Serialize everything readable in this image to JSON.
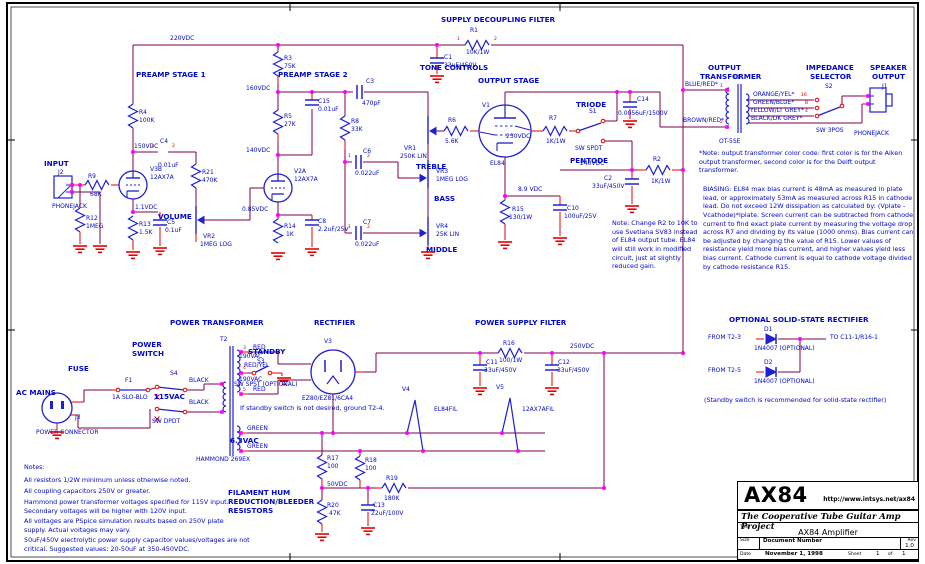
{
  "titleblock": {
    "logo": "AX84",
    "url": "http://www.intsys.net/ax84",
    "project": "The Cooperative Tube Guitar Amp Project",
    "title_label": "Title",
    "title": "AX84 Amplifier",
    "size_label": "Size",
    "doc_label": "Document Number",
    "rev_label": "Rev",
    "rev": "1.0",
    "date_label": "Date",
    "date": "November 1, 1998",
    "sheet_label": "Sheet",
    "sheet": "1",
    "of_label": "of",
    "sheet_total": "1"
  },
  "notes": {
    "heading": "Notes:",
    "n1": "All resistors 1/2W minimum unless otherwise noted.",
    "n2": "All coupling capacitors 250V or greater.",
    "n3": "Hammond power transformer voltages specified for 115V input.  Secondary voltages will be higher with 120V input.",
    "n4": "All voltages are PSpice simulation results based on 250V plate supply. Actual voltages may vary.",
    "n5": "50uF/450V electrolytic power supply capacitor values/voltages are not critical.  Suggested values: 20-50uF at 350-450VDC.",
    "ot_note": "*Note: output transformer color code: first color is for the Aiken output transformer, second color is for the Delft output transformer.",
    "biasing": "BIASING:  EL84 max bias current is 48mA as measured in plate lead,  or approximately 53mA as measured across R15 in cathode lead.  Do not exceed 12W dissipation as calculated by: (Vplate - Vcathode)*Iplate.  Screen current can be subtracted from cathode current to find exact plate current by measuring the voltage drop across R7 and dividing by its value (1000 ohms).  Bias current can be adjusted by changing the value of R15.  Lower values of resistance yield more bias current, and higher values yield less bias current.  Cathode current is equal to cathode voltage divided by cathode resistance R15.",
    "sv83_note": "Note: Change R2 to 10K to use Svetlana SV83 instead of EL84 output tube. EL84 will still work in modified circuit, just at slightly reduced gain.",
    "standby_note": "If standby switch is not desired, ground T2-4.",
    "ss_note": "(Standby switch is recommended for solid-state rectifier)"
  },
  "colors": {
    "wire": "#7d004f",
    "lead": "#e60000",
    "component": "#2020d0",
    "junction": "#ff00ff",
    "label": "#0008cc"
  },
  "labels": [
    [
      "SUPPLY DECOUPLING FILTER",
      441,
      16,
      "b"
    ],
    [
      "PREAMP STAGE 1",
      136,
      71,
      "b"
    ],
    [
      "PREAMP STAGE 2",
      278,
      71,
      "b"
    ],
    [
      "TONE CONTROLS",
      420,
      64,
      "b"
    ],
    [
      "OUTPUT STAGE",
      478,
      77,
      "b"
    ],
    [
      "TRIODE",
      576,
      101,
      "b"
    ],
    [
      "PENTODE",
      570,
      157,
      "b"
    ],
    [
      "INPUT",
      44,
      160,
      "b"
    ],
    [
      "VOLUME",
      158,
      213,
      "b"
    ],
    [
      "TREBLE",
      416,
      163,
      "b"
    ],
    [
      "BASS",
      434,
      195,
      "b"
    ],
    [
      "MIDDLE",
      426,
      246,
      "b"
    ],
    [
      "OUTPUT",
      708,
      64,
      "b"
    ],
    [
      "TRANSFORMER",
      700,
      73,
      "b"
    ],
    [
      "IMPEDANCE",
      806,
      64,
      "b"
    ],
    [
      "SELECTOR",
      810,
      73,
      "b"
    ],
    [
      "SPEAKER",
      870,
      64,
      "b"
    ],
    [
      "OUTPUT",
      872,
      73,
      "b"
    ],
    [
      "POWER TRANSFORMER",
      170,
      319,
      "b"
    ],
    [
      "RECTIFIER",
      314,
      319,
      "b"
    ],
    [
      "POWER SUPPLY FILTER",
      475,
      319,
      "b"
    ],
    [
      "OPTIONAL SOLID-STATE RECTIFIER",
      729,
      316,
      "b"
    ],
    [
      "POWER",
      132,
      341,
      "b"
    ],
    [
      "SWITCH",
      132,
      350,
      "b"
    ],
    [
      "FUSE",
      68,
      365,
      "b"
    ],
    [
      "AC MAINS",
      16,
      389,
      "b"
    ],
    [
      "STANDBY",
      248,
      348,
      "b"
    ],
    [
      "115VAC",
      154,
      393,
      "b"
    ],
    [
      "6.3VAC",
      230,
      437,
      "b"
    ],
    [
      "FILAMENT HUM",
      228,
      489,
      "b"
    ],
    [
      "REDUCTION/BLEEDER",
      228,
      498,
      "b"
    ],
    [
      "RESISTORS",
      228,
      507,
      "b"
    ],
    [
      "220VDC",
      170,
      36,
      "n"
    ],
    [
      "R1",
      470,
      28,
      "n"
    ],
    [
      "10K/1W",
      466,
      50,
      "n"
    ],
    [
      "C1",
      444,
      55,
      "n"
    ],
    [
      "33uF/450V",
      444,
      63,
      "n"
    ],
    [
      "R4",
      139,
      110,
      "n"
    ],
    [
      "100K",
      139,
      118,
      "n"
    ],
    [
      "150VDC",
      134,
      144,
      "n"
    ],
    [
      "C4",
      160,
      139,
      "n"
    ],
    [
      "0.01uF",
      158,
      163,
      "n"
    ],
    [
      "V3B",
      150,
      167,
      "n"
    ],
    [
      "12AX7A",
      150,
      175,
      "n"
    ],
    [
      "J2",
      58,
      170,
      "n"
    ],
    [
      "PHONEJACK",
      52,
      204,
      "n"
    ],
    [
      "R9",
      88,
      174,
      "n"
    ],
    [
      "68K",
      90,
      192,
      "n"
    ],
    [
      "R12",
      86,
      216,
      "n"
    ],
    [
      "1MEG",
      86,
      224,
      "n"
    ],
    [
      "1.1VDC",
      135,
      205,
      "n"
    ],
    [
      "R13",
      139,
      222,
      "n"
    ],
    [
      "1.5K",
      139,
      230,
      "n"
    ],
    [
      "C5",
      167,
      220,
      "n"
    ],
    [
      "0.1uF",
      165,
      228,
      "n"
    ],
    [
      "R21",
      202,
      170,
      "n"
    ],
    [
      "470K",
      202,
      178,
      "n"
    ],
    [
      "VR2",
      203,
      234,
      "n"
    ],
    [
      "1MEG LOG",
      200,
      242,
      "n"
    ],
    [
      "R3",
      284,
      56,
      "n"
    ],
    [
      "75K",
      284,
      64,
      "n"
    ],
    [
      "160VDC",
      246,
      86,
      "n"
    ],
    [
      "R5",
      284,
      114,
      "n"
    ],
    [
      "27K",
      284,
      122,
      "n"
    ],
    [
      "C15",
      318,
      99,
      "n"
    ],
    [
      "0.01uF",
      318,
      107,
      "n"
    ],
    [
      "140VDC",
      246,
      148,
      "n"
    ],
    [
      "V2A",
      294,
      169,
      "n"
    ],
    [
      "12AX7A",
      294,
      177,
      "n"
    ],
    [
      "0.85VDC",
      242,
      207,
      "n"
    ],
    [
      "R14",
      284,
      224,
      "n"
    ],
    [
      "1K",
      286,
      232,
      "n"
    ],
    [
      "C8",
      318,
      219,
      "n"
    ],
    [
      "2.2uF/25V",
      318,
      227,
      "n"
    ],
    [
      "C3",
      366,
      79,
      "n"
    ],
    [
      "470pF",
      362,
      101,
      "n"
    ],
    [
      "R8",
      351,
      119,
      "n"
    ],
    [
      "33K",
      351,
      127,
      "n"
    ],
    [
      "C6",
      363,
      149,
      "n"
    ],
    [
      "0.022uF",
      355,
      171,
      "n"
    ],
    [
      "C7",
      363,
      220,
      "n"
    ],
    [
      "0.022uF",
      355,
      242,
      "n"
    ],
    [
      "VR1",
      404,
      146,
      "n"
    ],
    [
      "250K LIN",
      400,
      154,
      "n"
    ],
    [
      "VR3",
      436,
      169,
      "n"
    ],
    [
      "1MEG LOG",
      436,
      177,
      "n"
    ],
    [
      "VR4",
      436,
      224,
      "n"
    ],
    [
      "25K LIN",
      436,
      232,
      "n"
    ],
    [
      "R6",
      448,
      118,
      "n"
    ],
    [
      "5.6K",
      445,
      139,
      "n"
    ],
    [
      "V1",
      482,
      103,
      "n"
    ],
    [
      "EL84",
      490,
      161,
      "n"
    ],
    [
      "R7",
      549,
      116,
      "n"
    ],
    [
      "1K/1W",
      546,
      139,
      "n"
    ],
    [
      "230VDC",
      506,
      134,
      "n"
    ],
    [
      "S1",
      589,
      109,
      "n"
    ],
    [
      "SW SPDT",
      575,
      146,
      "n"
    ],
    [
      "8.9 VDC",
      518,
      187,
      "n"
    ],
    [
      "R15",
      512,
      207,
      "n"
    ],
    [
      "130/1W",
      509,
      215,
      "n"
    ],
    [
      "C10",
      567,
      206,
      "n"
    ],
    [
      "100uF/25V",
      564,
      214,
      "n"
    ],
    [
      "C14",
      637,
      97,
      "n"
    ],
    [
      "0.0056uF/1500V",
      618,
      111,
      "n"
    ],
    [
      "240VDC",
      580,
      161,
      "n"
    ],
    [
      "R2",
      653,
      157,
      "n"
    ],
    [
      "1K/1W",
      651,
      179,
      "n"
    ],
    [
      "C2",
      604,
      176,
      "n"
    ],
    [
      "33uF/450V",
      592,
      184,
      "n"
    ],
    [
      "T1",
      733,
      75,
      "n"
    ],
    [
      "OT-5SE",
      719,
      139,
      "n"
    ],
    [
      "BLUE/RED*",
      685,
      82,
      "n"
    ],
    [
      "BROWN/RED*",
      683,
      118,
      "n"
    ],
    [
      "ORANGE/YEL*",
      753,
      92,
      "n"
    ],
    [
      "GREEN/BLUE*",
      753,
      100,
      "n"
    ],
    [
      "YELLOW/LT GREY*",
      750,
      108,
      "n"
    ],
    [
      "BLACK/DK GREY*",
      751,
      116,
      "n"
    ],
    [
      "S2",
      825,
      84,
      "n"
    ],
    [
      "SW 3POS",
      816,
      128,
      "n"
    ],
    [
      "J1",
      882,
      84,
      "n"
    ],
    [
      "PHONEJACK",
      854,
      131,
      "n"
    ],
    [
      "T2",
      220,
      337,
      "n"
    ],
    [
      "RED",
      253,
      345,
      "n"
    ],
    [
      "RED/YEL",
      244,
      363,
      "n"
    ],
    [
      "RED",
      253,
      387,
      "n"
    ],
    [
      "190VAC",
      239,
      354,
      "n"
    ],
    [
      "190VAC",
      239,
      377,
      "n"
    ],
    [
      "S3",
      257,
      359,
      "n"
    ],
    [
      "SW SPST (OPTIONAL)",
      234,
      382,
      "n"
    ],
    [
      "GREEN",
      247,
      426,
      "n"
    ],
    [
      "GREEN",
      247,
      444,
      "n"
    ],
    [
      "HAMMOND 269EX",
      196,
      457,
      "n"
    ],
    [
      "F1",
      125,
      378,
      "n"
    ],
    [
      "1A SLO-BLO",
      112,
      395,
      "n"
    ],
    [
      "S4",
      170,
      371,
      "n"
    ],
    [
      "SW DPDT",
      152,
      419,
      "n"
    ],
    [
      "BLACK",
      189,
      378,
      "n"
    ],
    [
      "BLACK",
      189,
      400,
      "n"
    ],
    [
      "J3",
      75,
      415,
      "n"
    ],
    [
      "POWER CONNECTOR",
      36,
      430,
      "n"
    ],
    [
      "V3",
      324,
      339,
      "n"
    ],
    [
      "EZ80/EZ81/6CA4",
      302,
      396,
      "n"
    ],
    [
      "V4",
      402,
      387,
      "n"
    ],
    [
      "EL84FIL",
      434,
      407,
      "n"
    ],
    [
      "V5",
      496,
      385,
      "n"
    ],
    [
      "12AX7AFIL",
      522,
      407,
      "n"
    ],
    [
      "R16",
      503,
      341,
      "n"
    ],
    [
      "100/1W",
      499,
      358,
      "n"
    ],
    [
      "250VDC",
      570,
      344,
      "n"
    ],
    [
      "C11",
      486,
      360,
      "n"
    ],
    [
      "33uF/450V",
      484,
      368,
      "n"
    ],
    [
      "C12",
      558,
      360,
      "n"
    ],
    [
      "33uF/450V",
      557,
      368,
      "n"
    ],
    [
      "FROM T2-3",
      708,
      335,
      "n"
    ],
    [
      "D1",
      764,
      327,
      "n"
    ],
    [
      "1N4007 (OPTIONAL)",
      754,
      346,
      "n"
    ],
    [
      "TO C11-1/R16-1",
      830,
      335,
      "n"
    ],
    [
      "FROM T2-5",
      708,
      368,
      "n"
    ],
    [
      "D2",
      764,
      360,
      "n"
    ],
    [
      "1N4007 (OPTIONAL)",
      754,
      379,
      "n"
    ],
    [
      "R17",
      327,
      456,
      "n"
    ],
    [
      "100",
      327,
      464,
      "n"
    ],
    [
      "R18",
      365,
      458,
      "n"
    ],
    [
      "100",
      365,
      466,
      "n"
    ],
    [
      "50VDC",
      327,
      482,
      "n"
    ],
    [
      "R19",
      386,
      476,
      "n"
    ],
    [
      "180K",
      384,
      496,
      "n"
    ],
    [
      "R20",
      327,
      503,
      "n"
    ],
    [
      "47K",
      329,
      511,
      "n"
    ],
    [
      "C13",
      373,
      503,
      "n"
    ],
    [
      "22uF/100V",
      371,
      511,
      "n"
    ],
    [
      "1",
      720,
      85,
      "p"
    ],
    [
      "2",
      720,
      121,
      "p"
    ],
    [
      "16",
      801,
      94,
      "p"
    ],
    [
      "8",
      805,
      102,
      "p"
    ],
    [
      "4",
      805,
      110,
      "p"
    ],
    [
      "3",
      243,
      347,
      "p"
    ],
    [
      "4",
      243,
      367,
      "p"
    ],
    [
      "5",
      243,
      389,
      "p"
    ],
    [
      "1",
      151,
      145,
      "p"
    ],
    [
      "2",
      172,
      145,
      "p"
    ],
    [
      "1",
      348,
      155,
      "p"
    ],
    [
      "2",
      367,
      155,
      "p"
    ],
    [
      "1",
      348,
      226,
      "p"
    ],
    [
      "2",
      367,
      226,
      "p"
    ],
    [
      "1",
      457,
      38,
      "p"
    ],
    [
      "2",
      494,
      38,
      "p"
    ]
  ]
}
